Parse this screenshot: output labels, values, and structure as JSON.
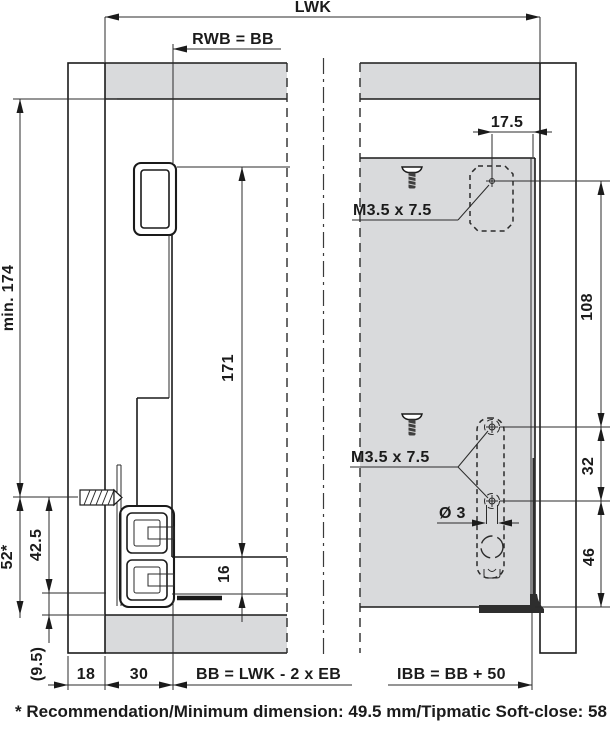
{
  "colors": {
    "panel_fill": "#d9dadc",
    "line": "#1a1a1a",
    "dim_line": "#2b2b2b",
    "bracket_dark": "#2e2e2e"
  },
  "dims": {
    "lwk": "LWK",
    "rwb_bb": "RWB = BB",
    "min_174": "min. 174",
    "h171": "171",
    "s52": "52*",
    "s425": "42.5",
    "s95": "(9.5)",
    "t16": "16",
    "w18": "18",
    "w30": "30",
    "bb_formula": "BB = LWK - 2 x EB",
    "ibb_formula": "IBB = BB + 50",
    "w175": "17.5",
    "v108": "108",
    "v32": "32",
    "v46": "46",
    "dia3": "Ø 3"
  },
  "labels": {
    "screw_spec_top": "M3.5 x 7.5",
    "screw_spec_mid": "M3.5 x 7.5"
  },
  "footer": {
    "note": "* Recommendation/Minimum dimension: 49.5 mm/Tipmatic Soft-close: 58 mm"
  }
}
